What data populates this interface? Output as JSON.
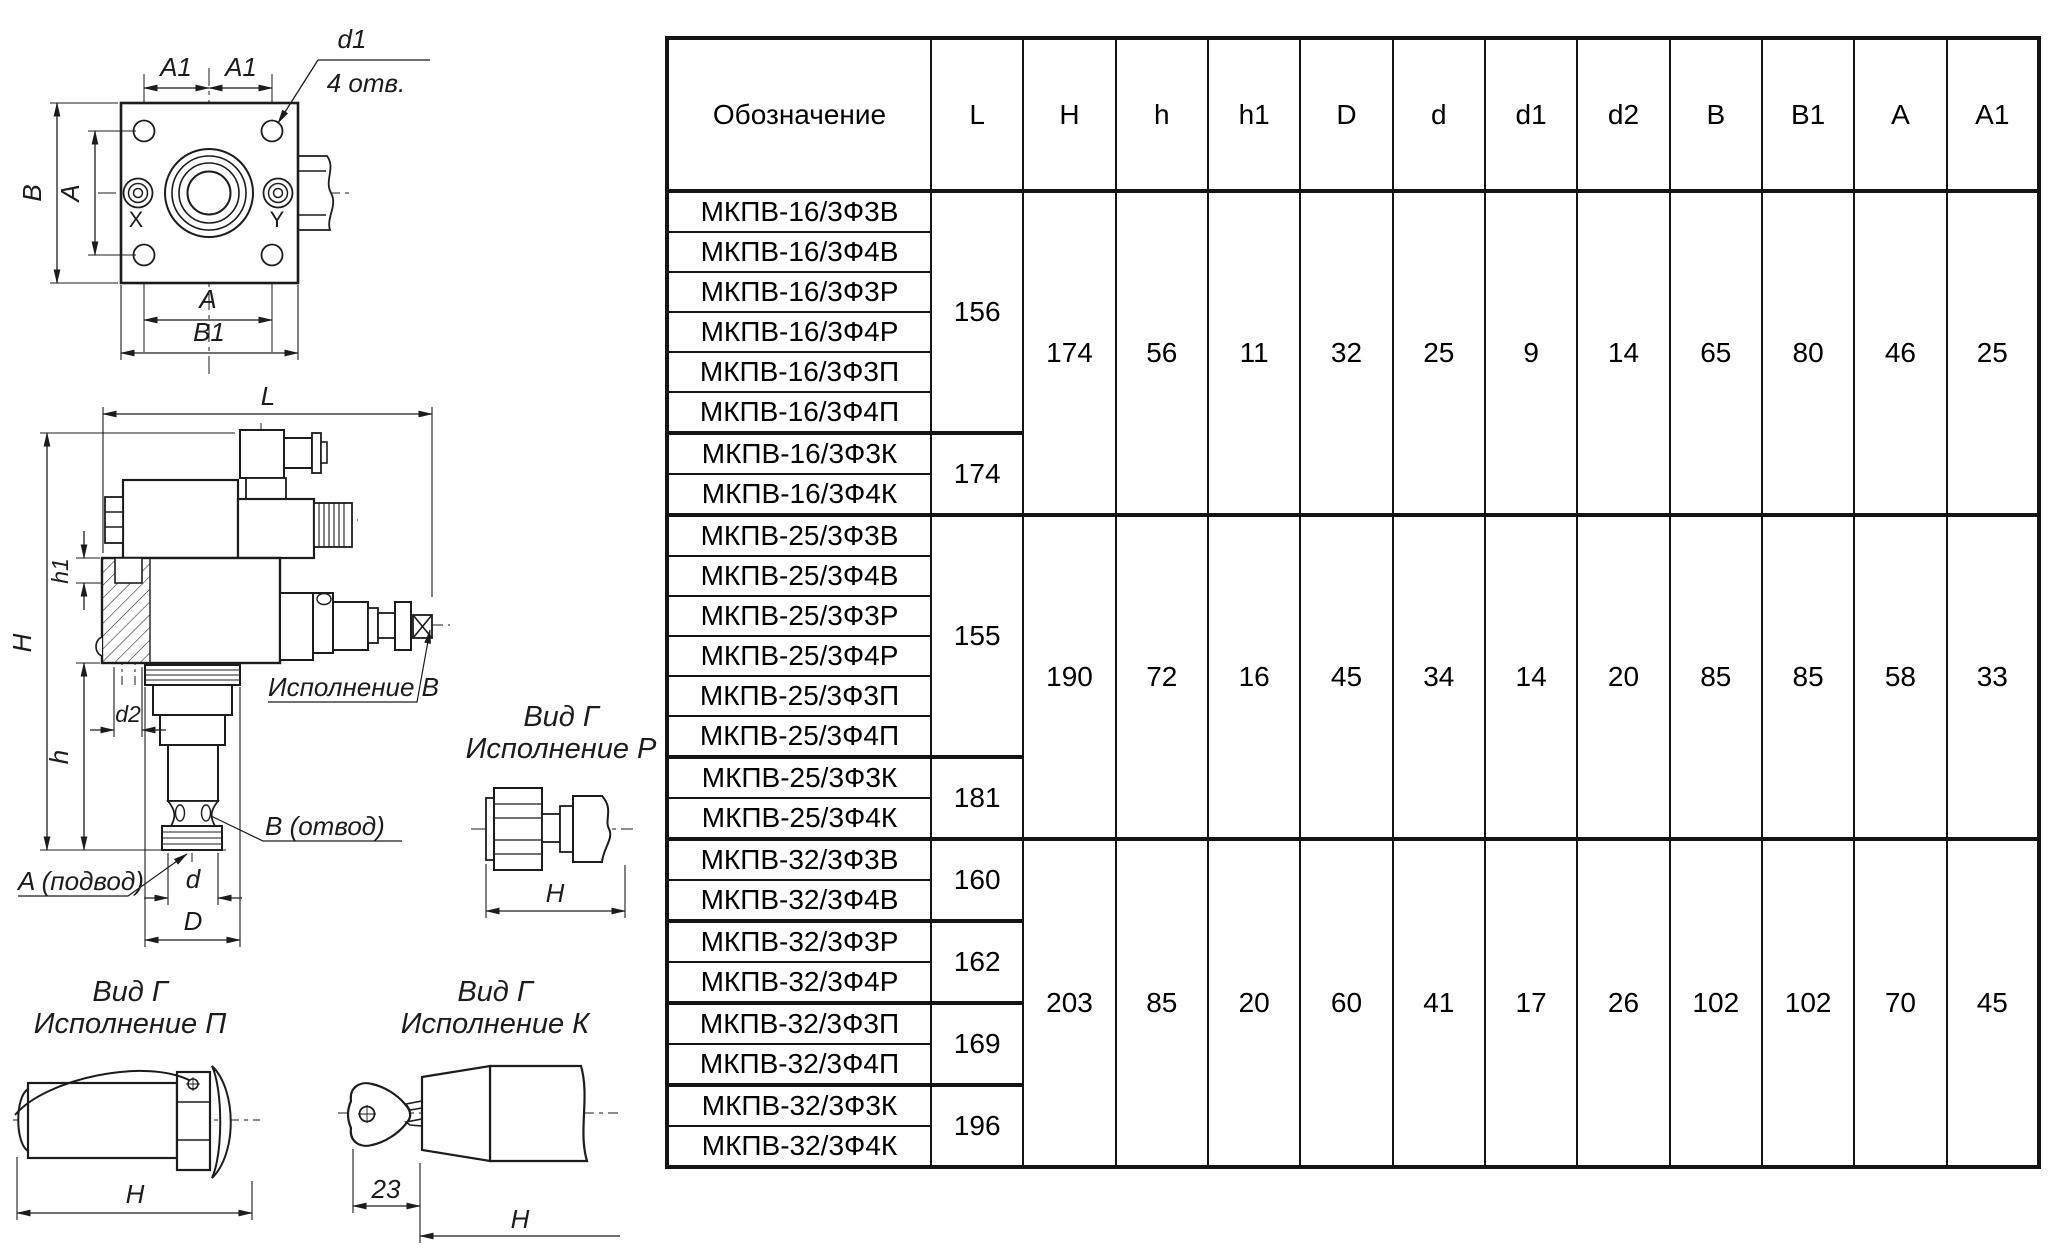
{
  "table": {
    "headers": [
      "Обозначение",
      "L",
      "H",
      "h",
      "h1",
      "D",
      "d",
      "d1",
      "d2",
      "B",
      "B1",
      "A",
      "A1"
    ],
    "groups": [
      {
        "shared": [
          "174",
          "56",
          "11",
          "32",
          "25",
          "9",
          "14",
          "65",
          "80",
          "46",
          "25"
        ],
        "l_groups": [
          {
            "l": "156",
            "names": [
              "МКПВ-16/3Ф3В",
              "МКПВ-16/3Ф4В",
              "МКПВ-16/3Ф3Р",
              "МКПВ-16/3Ф4Р",
              "МКПВ-16/3Ф3П",
              "МКПВ-16/3Ф4П"
            ]
          },
          {
            "l": "174",
            "names": [
              "МКПВ-16/3Ф3К",
              "МКПВ-16/3Ф4К"
            ]
          }
        ]
      },
      {
        "shared": [
          "190",
          "72",
          "16",
          "45",
          "34",
          "14",
          "20",
          "85",
          "85",
          "58",
          "33"
        ],
        "l_groups": [
          {
            "l": "155",
            "names": [
              "МКПВ-25/3Ф3В",
              "МКПВ-25/3Ф4В",
              "МКПВ-25/3Ф3Р",
              "МКПВ-25/3Ф4Р",
              "МКПВ-25/3Ф3П",
              "МКПВ-25/3Ф4П"
            ]
          },
          {
            "l": "181",
            "names": [
              "МКПВ-25/3Ф3К",
              "МКПВ-25/3Ф4К"
            ]
          }
        ]
      },
      {
        "shared": [
          "203",
          "85",
          "20",
          "60",
          "41",
          "17",
          "26",
          "102",
          "102",
          "70",
          "45"
        ],
        "l_groups": [
          {
            "l": "160",
            "names": [
              "МКПВ-32/3Ф3В",
              "МКПВ-32/3Ф4В"
            ]
          },
          {
            "l": "162",
            "names": [
              "МКПВ-32/3Ф3Р",
              "МКПВ-32/3Ф4Р"
            ]
          },
          {
            "l": "169",
            "names": [
              "МКПВ-32/3Ф3П",
              "МКПВ-32/3Ф4П"
            ]
          },
          {
            "l": "196",
            "names": [
              "МКПВ-32/3Ф3К",
              "МКПВ-32/3Ф4К"
            ]
          }
        ]
      }
    ]
  },
  "drawings": {
    "flange": {
      "a1_left": "A1",
      "a1_right": "A1",
      "d1": "d1",
      "holes": "4 отв.",
      "b": "B",
      "a_side": "A",
      "x": "X",
      "y": "Y",
      "a_bottom": "A",
      "b1": "B1"
    },
    "side_view": {
      "l": "L",
      "h_total": "H",
      "h1": "h1",
      "d2": "d2",
      "h": "h",
      "version_b": "Исполнение В",
      "b_port": "B (отвод)",
      "a_port": "A (подвод)",
      "d": "d",
      "d_big": "D"
    },
    "view_r": {
      "line1": "Вид Г",
      "line2": "Исполнение Р",
      "h": "H"
    },
    "view_p": {
      "line1": "Вид Г",
      "line2": "Исполнение П",
      "h": "H"
    },
    "view_k": {
      "line1": "Вид Г",
      "line2": "Исполнение К",
      "dim23": "23",
      "h": "H"
    }
  }
}
